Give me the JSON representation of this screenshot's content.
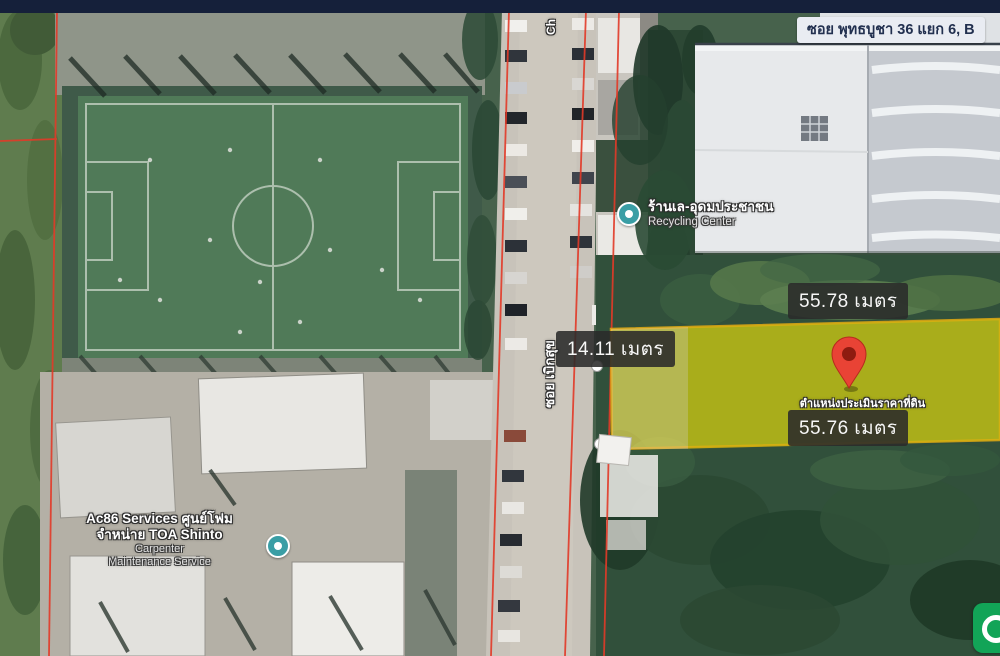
{
  "address_label": {
    "text": "ซอย พุทธบูชา 36 แยก 6, B"
  },
  "measurements": {
    "north": "55.78 เมตร",
    "west": "14.11 เมตร",
    "south": "55.76 เมตร"
  },
  "plot": {
    "caption": "ตำแหน่งประเมินราคาที่ดิน",
    "highlight_color": "#ecdb13",
    "border_color": "#d9a515",
    "pin_color": "#e94335"
  },
  "pois": {
    "recycling": {
      "name_th": "ร้านเล-อุดมประชาชน",
      "name_en": "Recycling Center"
    },
    "services": {
      "line1": "Ac86 Services ศูนย์โฟม",
      "line2": "จำหน่าย TOA Shinto",
      "line3": "Carpenter",
      "line4": "Maintenance Service"
    }
  },
  "roads": {
    "vertical_label": "ซอย เบิกสุข",
    "top_partial_label": "Ch"
  },
  "icons": {
    "location_pin": "red-teardrop-pin",
    "poi_dot": "teal-circle",
    "corner_button_color": "#12a457"
  },
  "colors": {
    "top_bar": "#15203a",
    "address_chip_bg": "#e9ecf2",
    "measure_chip_bg": "#2a2a2a",
    "cadastral_line": "#e23a28"
  }
}
